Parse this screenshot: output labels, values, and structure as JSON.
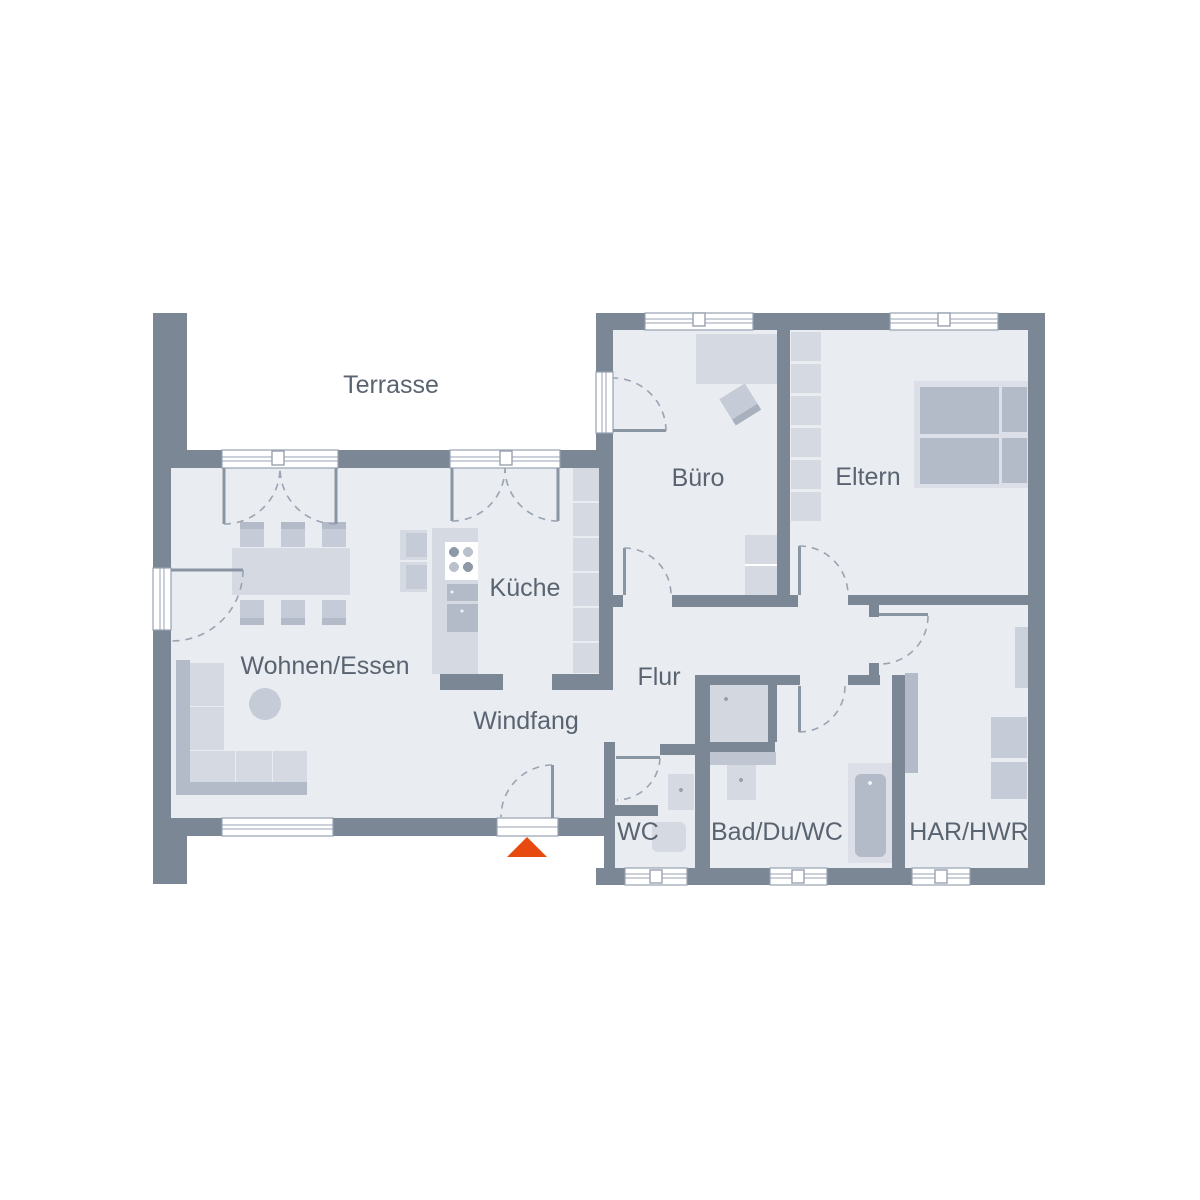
{
  "plan": {
    "title": "Erdgeschoss Grundriss",
    "colors": {
      "background": "#ffffff",
      "wall": "#7c8796",
      "floor": "#e9ecf1",
      "furniture_xlight": "#dcdfe7",
      "furniture_light": "#d5d9e2",
      "furniture_mid": "#c6ccd7",
      "furniture_dark": "#b4bbc8",
      "window_line": "#98a2b0",
      "text": "#5a6471",
      "accent": "#e8490f"
    },
    "rooms": [
      {
        "id": "terrasse",
        "label": "Terrasse"
      },
      {
        "id": "wohnen-essen",
        "label": "Wohnen/Essen"
      },
      {
        "id": "kueche",
        "label": "Küche"
      },
      {
        "id": "windfang",
        "label": "Windfang"
      },
      {
        "id": "flur",
        "label": "Flur"
      },
      {
        "id": "buero",
        "label": "Büro"
      },
      {
        "id": "eltern",
        "label": "Eltern"
      },
      {
        "id": "wc",
        "label": "WC"
      },
      {
        "id": "bad-du-wc",
        "label": "Bad/Du/WC"
      },
      {
        "id": "har-hwr",
        "label": "HAR/HWR"
      }
    ],
    "entrance": {
      "marker": "triangle-arrow-up"
    }
  }
}
